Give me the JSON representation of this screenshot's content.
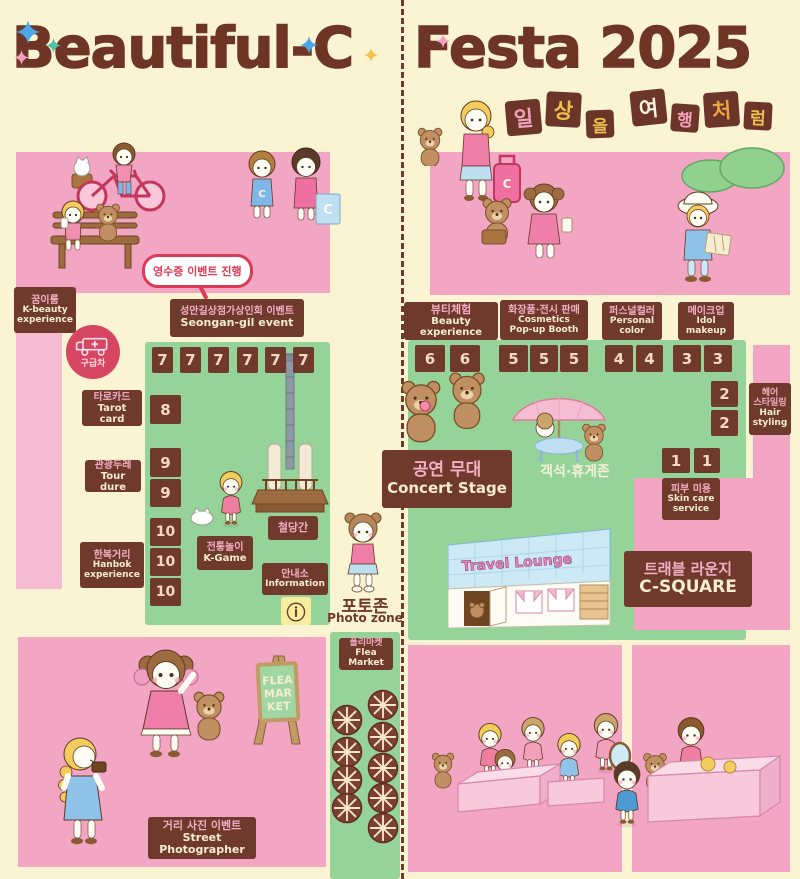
{
  "header": {
    "title_left": "Beautiful-C",
    "title_right": "Festa 2025",
    "slogan_chars": [
      {
        "ch": "일",
        "color": "#f2a2b8",
        "dy": 10,
        "small": false
      },
      {
        "ch": "상",
        "color": "#eec14e",
        "dy": 2,
        "small": false
      },
      {
        "ch": "을",
        "color": "#eec14e",
        "dy": 20,
        "small": true
      },
      {
        "ch": "여",
        "color": "#fdf1dd",
        "dy": 0,
        "small": false
      },
      {
        "ch": "행",
        "color": "#f2a2b8",
        "dy": 14,
        "small": true
      },
      {
        "ch": "처",
        "color": "#eda43f",
        "dy": 2,
        "small": false
      },
      {
        "ch": "럼",
        "color": "#eec14e",
        "dy": 12,
        "small": true
      }
    ]
  },
  "left_map": {
    "kbeauty": {
      "ko": "꿈이룸",
      "en1": "K-beauty",
      "en2": "experience"
    },
    "receipt_bubble": "영수증 이벤트 진행",
    "seongan": {
      "ko": "성안길상점가상인회 이벤트",
      "en": "Seongan-gil event"
    },
    "ambulance": "구급차",
    "tarot": {
      "ko": "타로카드",
      "en": "Tarot card"
    },
    "tour": {
      "ko": "관광두레",
      "en": "Tour dure"
    },
    "hanbok": {
      "ko": "한복거리",
      "en1": "Hanbok",
      "en2": "experience"
    },
    "row7": [
      "7",
      "7",
      "7",
      "7",
      "7",
      "7"
    ],
    "col_numbers": [
      "8",
      "9",
      "9",
      "10",
      "10",
      "10"
    ],
    "kgame": {
      "ko": "전통놀이",
      "en": "K-Game"
    },
    "tower": {
      "ko": "철당간"
    },
    "info": {
      "ko": "안내소",
      "en": "Information",
      "icon": "ⓘ"
    }
  },
  "center": {
    "photo": {
      "ko": "포토존",
      "en": "Photo zone"
    },
    "flea": {
      "ko": "플리마켓",
      "en": "Flea Market"
    }
  },
  "right_map": {
    "booths": [
      {
        "ko": "뷰티체험",
        "en": [
          "Beauty experience"
        ],
        "numbers": [
          "6",
          "6"
        ]
      },
      {
        "ko": "화장품·전시 판매",
        "en": [
          "Cosmetics",
          "Pop-up Booth"
        ],
        "numbers": [
          "5",
          "5",
          "5"
        ]
      },
      {
        "ko": "퍼스널컬러",
        "en": [
          "Personal",
          "color"
        ],
        "numbers": [
          "4",
          "4"
        ]
      },
      {
        "ko": "메이크업",
        "en": [
          "Idol",
          "makeup"
        ],
        "numbers": [
          "3",
          "3"
        ]
      }
    ],
    "hair": {
      "ko1": "헤어",
      "ko2": "스타일링",
      "en1": "Hair",
      "en2": "styling",
      "numbers": [
        "2",
        "2"
      ]
    },
    "skin": {
      "ko": "피부 미용",
      "en1": "Skin care",
      "en2": "service",
      "numbers": [
        "1",
        "1"
      ]
    },
    "stage": {
      "ko": "공연 무대",
      "en": "Concert Stage"
    },
    "seating": "객석·휴게존",
    "lounge_sign": "Travel Lounge",
    "lounge": {
      "ko": "트래블 라운지",
      "en": "C-SQUARE"
    }
  },
  "bottom": {
    "street": {
      "ko": "거리 사진 이벤트",
      "en": "Street Photographer"
    },
    "flea_sign": [
      "FLEA",
      "MAR",
      "KET"
    ],
    "bag_letter": "C"
  },
  "colors": {
    "pink_panel": "#f3a6c4",
    "pink_strip": "#f6bbd2",
    "green_zone": "#95d398",
    "cream_bg": "#fbf4d2",
    "brown_box": "#6f392b",
    "title_brown": "#6e3526",
    "accent_red": "#dc3a55",
    "ambulance_red": "#d64562"
  }
}
